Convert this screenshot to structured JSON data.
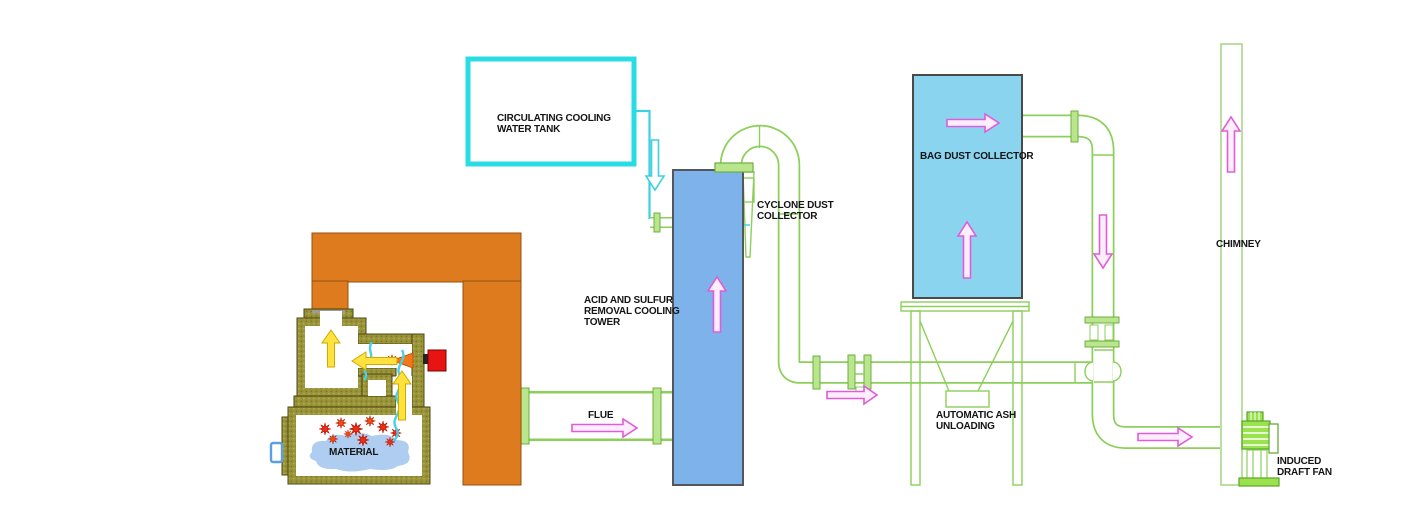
{
  "diagram": {
    "title": "Incinerator flue gas treatment process flow",
    "labels": {
      "tank": "CIRCULATING COOLING WATER TANK",
      "tower": "ACID AND SULFUR REMOVAL COOLING TOWER",
      "cyclone": "CYCLONE DUST COLLECTOR",
      "bag": "BAG DUST COLLECTOR",
      "ash": "AUTOMATIC ASH UNLOADING",
      "chimney": "CHIMNEY",
      "fan": "INDUCED DRAFT FAN",
      "flue": "FLUE",
      "material": "MATERIAL"
    },
    "colors": {
      "pipe_green": "#8ccf5a",
      "flange_green": "#b9e58d",
      "tower_blue": "#7db2ea",
      "bag_blue": "#8bd4ef",
      "tank_cyan": "#28dce4",
      "stack_orange": "#de7b1f",
      "furnace_olive": "#99933a",
      "flow_magenta": "#e05cd8",
      "hot_gas_yellow": "#ffe23e",
      "burner_red": "#e81414",
      "flame_orange": "#f07818",
      "material_blue": "#aecdf0",
      "spray_cyan": "#49cfe8",
      "label_black": "#141414"
    }
  }
}
